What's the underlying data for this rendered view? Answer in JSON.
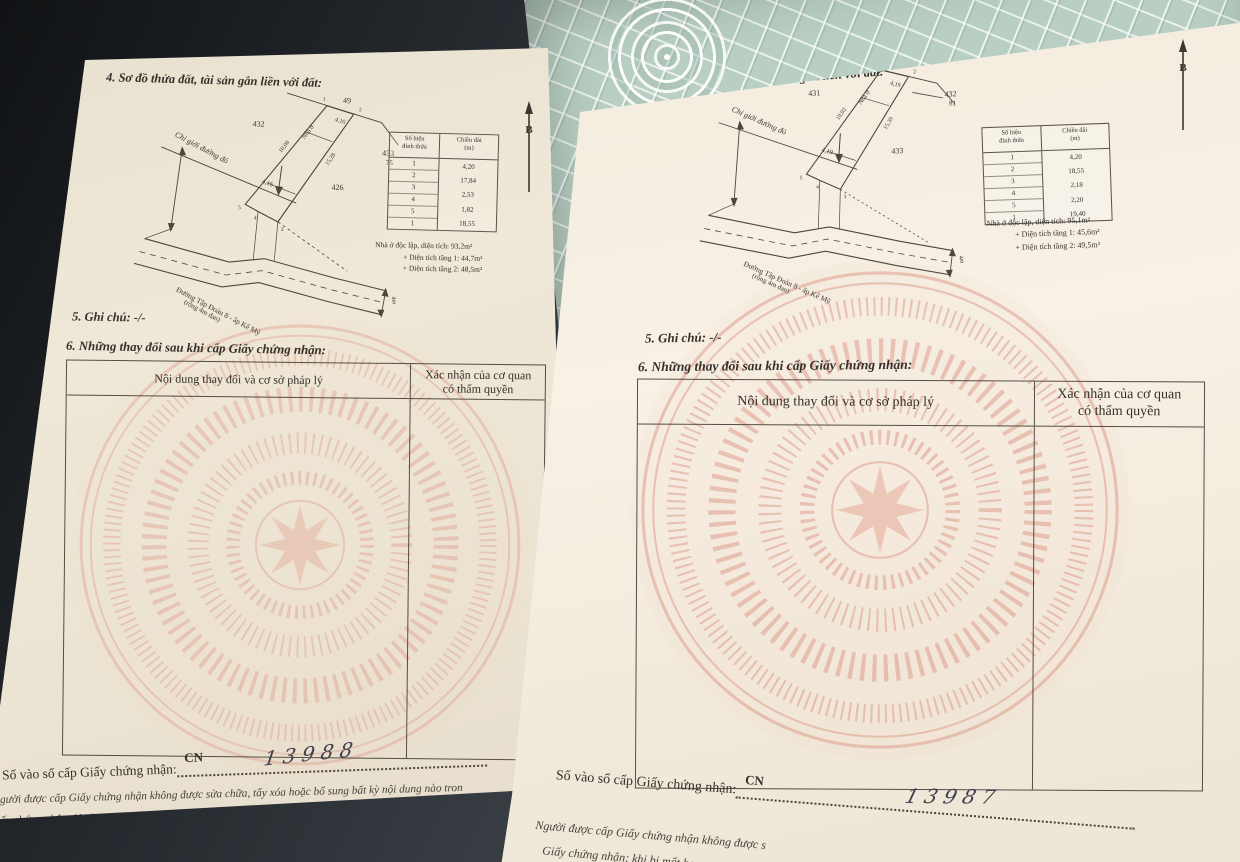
{
  "colors": {
    "paper": "#efe8d8",
    "paper_right": "#f6f0e6",
    "ink": "#35302a",
    "watermark_pink": "#dd9483",
    "mat_teal": "#b9cfc3",
    "background_dark": "#23262b"
  },
  "pages": {
    "left": {
      "section4_title": "4. Sơ đồ thửa đất, tài sản gắn liền với đất:",
      "north_label": "B",
      "diagram": {
        "lot_top": "49",
        "lot_left": "432",
        "lot_right": "433",
        "lot_right_sub": "75",
        "lot_mid": "426",
        "v1": "1",
        "v2": "2",
        "v3": "3",
        "v4": "4",
        "v5": "5",
        "edge_top": "4,16",
        "edge_cross": "4,16",
        "dim_left": "10,08",
        "dim_right": "15,28",
        "house_label": "Nhà ở",
        "red_boundary_label": "Chỉ giới đường đỏ",
        "road_name": "Đường Tập Đoàn 8 - ấp Kế Mỹ",
        "road_note": "(rộng 4m đan)",
        "road_width": "4m"
      },
      "vertex_table": {
        "header_col1_line1": "Số hiệu",
        "header_col1_line2": "đỉnh thửa",
        "header_col2_line1": "Chiều dài",
        "header_col2_line2": "(m)",
        "vertices": [
          "1",
          "2",
          "3",
          "4",
          "5",
          "1"
        ],
        "lengths": [
          "4,20",
          "17,84",
          "2,53",
          "1,82",
          "18,55"
        ]
      },
      "house_info": {
        "line1": "Nhà ở độc lập, diện tích: 93,2m²",
        "line2": "+ Diện tích tầng 1: 44,7m²",
        "line3": "+ Diện tích tầng 2: 48,5m²"
      },
      "section5_title": "5. Ghi chú: -/-",
      "section6_title": "6. Những thay đổi sau khi cấp Giấy chứng nhận:",
      "change_table": {
        "col1_header": "Nội dung thay đổi và cơ sở pháp lý",
        "col2_header_line1": "Xác nhận của cơ quan",
        "col2_header_line2": "có thẩm quyền"
      },
      "footer": {
        "ledger_label": "Số vào sổ cấp Giấy chứng nhận:",
        "cn_prefix": "CN",
        "ledger_number": "13988",
        "note_line1": "gười được cấp Giấy chứng nhận không được sửa chữa, tẩy xóa hoặc bổ sung bất kỳ nội dung nào tron",
        "note_line2": "ấy chứng nhận; khi bị mất hoặc hư hỏng Giấy chứng nhận phải khai báo ngay với cơ quan cấp Giấy."
      }
    },
    "right": {
      "section4_title": "4. Sơ đồ thửa đất, tài sản gắn liền với đất:",
      "north_label": "B",
      "diagram": {
        "lot_top": "49",
        "lot_left": "431",
        "lot_right": "432",
        "lot_right_sub": "81",
        "lot_mid": "433",
        "v1": "1",
        "v2": "2",
        "v3": "3",
        "v4": "4",
        "v5": "5",
        "edge_top": "4,19",
        "edge_cross": "4,19",
        "dim_left": "10,92",
        "dim_right": "15,39",
        "house_label": "Nhà ở",
        "red_boundary_label": "Chỉ giới đường đỏ",
        "road_name": "Đường Tập Đoàn 8 - ấp Kế Mỹ",
        "road_note": "(rộng 4m đan)",
        "road_width": "4m"
      },
      "vertex_table": {
        "header_col1_line1": "Số hiệu",
        "header_col1_line2": "đỉnh thửa",
        "header_col2_line1": "Chiều dài",
        "header_col2_line2": "(m)",
        "vertices": [
          "1",
          "2",
          "3",
          "4",
          "5",
          "1"
        ],
        "lengths": [
          "4,20",
          "18,55",
          "2,18",
          "2,20",
          "19,40"
        ]
      },
      "house_info": {
        "line1": "Nhà ở độc lập, diện tích: 95,1m²",
        "line2": "+ Diện tích tầng 1: 45,6m²",
        "line3": "+ Diện tích tầng 2: 49,5m²"
      },
      "section5_title": "5. Ghi chú: -/-",
      "section6_title": "6. Những thay đổi sau khi cấp Giấy chứng nhận:",
      "change_table": {
        "col1_header": "Nội dung thay đổi và cơ sở pháp lý",
        "col2_header_line1": "Xác nhận của cơ quan",
        "col2_header_line2": "có thẩm quyền"
      },
      "footer": {
        "ledger_label": "Số vào sổ cấp Giấy chứng nhận:",
        "cn_prefix": "CN",
        "ledger_number": "13987",
        "note_line1": "Người được cấp Giấy chứng nhận không được s",
        "note_line2": "Giấy chứng nhận; khi bị mất ho"
      }
    }
  }
}
